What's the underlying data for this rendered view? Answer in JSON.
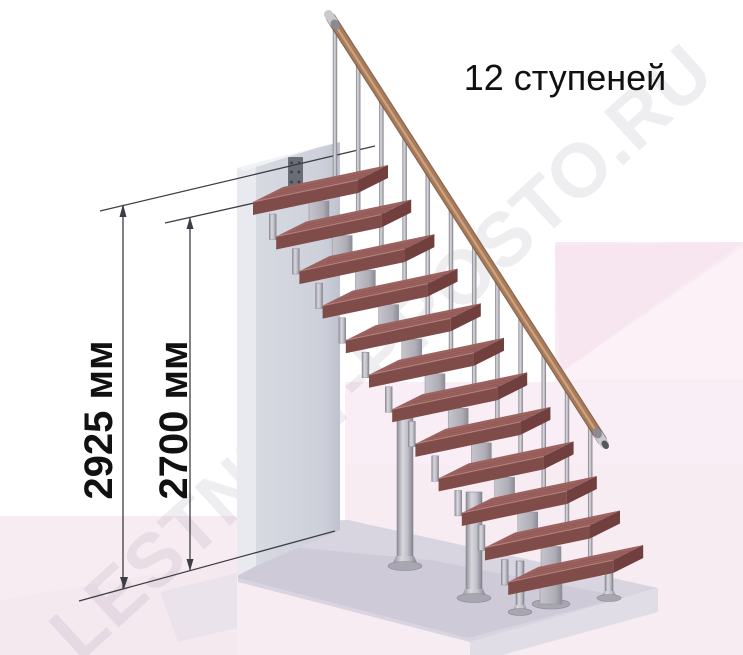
{
  "title": {
    "text": "12 ступеней"
  },
  "watermark": {
    "text": "LESTNICY-PROSTO.RU"
  },
  "dimensions": [
    {
      "id": "overall-height",
      "label": "2925 мм",
      "value": 2925,
      "unit": "мм"
    },
    {
      "id": "floor-to-landing-height",
      "label": "2700 мм",
      "value": 2700,
      "unit": "мм"
    }
  ],
  "staircase": {
    "steps_count": 12,
    "balusters_count": 12,
    "has_handrail": true,
    "type": "modular straight flight on central stringer"
  },
  "colors": {
    "tread_top": "#9c6260",
    "tread_front": "#7f4c49",
    "tread_side": "#713f3e",
    "tread_streak": "#84504d",
    "tread_edge_highlight": "#bb8880",
    "handrail_wood": "#a97b5a",
    "handrail_light": "#d0a782",
    "handrail_dark": "#7c5740",
    "metal_light": "#d8d7dd",
    "metal_mid": "#b5b4bc",
    "metal_dark": "#8f8e98",
    "wall_front": "#d3d6de",
    "wall_side": "#e8eaef",
    "wall_top": "#f1f2f5",
    "mount_plate": "#6a6d76",
    "slab_top": "#d8d4e0",
    "slab_front": "#e0dde7",
    "slab_shadow": "#cac5d4",
    "floor_pink": "#f8ecf3",
    "floor_pink_deep": "#f6e4ee",
    "floor_pink_light": "#fbf1f7",
    "dimension_line": "#3d3d45",
    "text": "#111111",
    "watermark": "#8d8498",
    "background": "#ffffff"
  }
}
